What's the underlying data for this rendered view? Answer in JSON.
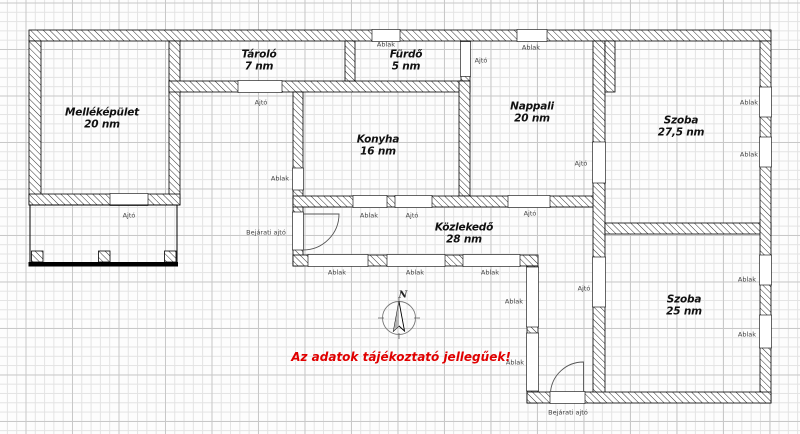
{
  "note": {
    "text": "Az adatok tájékoztató jellegűek!",
    "color": "#e00000"
  },
  "compass": {
    "north": "N"
  },
  "labels": {
    "window": "Ablak",
    "door": "Ajtó",
    "entrance_door": "Bejárati ajtó"
  },
  "rooms": [
    {
      "name": "Melléképület",
      "area": "20 nm"
    },
    {
      "name": "Tároló",
      "area": "7 nm"
    },
    {
      "name": "Fürdő",
      "area": "5 nm"
    },
    {
      "name": "Konyha",
      "area": "16 nm"
    },
    {
      "name": "Nappali",
      "area": "20 nm"
    },
    {
      "name": "Szoba",
      "area": "27,5 nm"
    },
    {
      "name": "Közlekedő",
      "area": "28 nm"
    },
    {
      "name": "Szoba",
      "area": "25 nm"
    }
  ]
}
